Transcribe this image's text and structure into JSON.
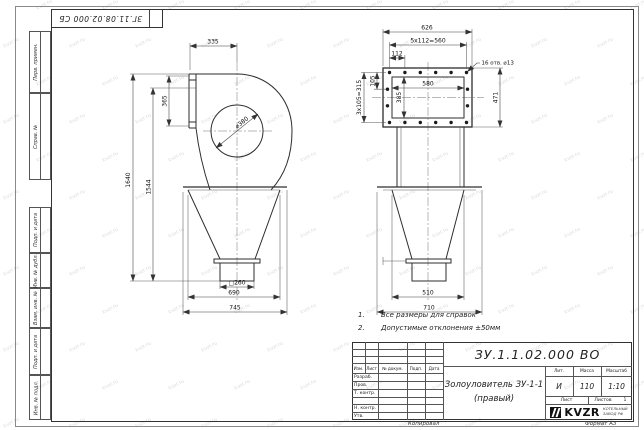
{
  "page": {
    "corner_stamp": "ЗГ.11.08.02.000 СБ",
    "copied_label": "Копировал",
    "format_label": "Формат А3",
    "watermark_text": "kvzr.ru"
  },
  "left_margin": {
    "labels": [
      "Перв. примен.",
      "Справ. №",
      "Подп. и дата",
      "Инв. № дубл.",
      "Взам. инв. №",
      "Подп. и дата",
      "Инв. № подл."
    ]
  },
  "notes": {
    "n1_num": "1.",
    "n1_text": "Все размеры для справок",
    "n2_num": "2.",
    "n2_text": "Допустимые отклонения ±50мм"
  },
  "title_block": {
    "doc_number": "ЗУ.1.1.02.000 ВО",
    "product_name_line1": "Золоуловитель ЗУ-1-1",
    "product_name_line2": "(правый)",
    "col_izm": "Изм.",
    "col_list": "Лист",
    "col_doc": "№ докум.",
    "col_sign": "Подп.",
    "col_date": "Дата",
    "row_developed": "Разраб.",
    "row_checked": "Пров.",
    "row_tcontrol": "Т. контр.",
    "row_ncontrol": "Н. контр.",
    "row_approved": "Утв.",
    "lit_label": "Лит.",
    "lit_value": "И",
    "mass_label": "Масса",
    "mass_value": "110",
    "scale_label": "Масштаб",
    "scale_value": "1:10",
    "sheet_label": "Лист",
    "sheets_label": "Листов",
    "sheets_value": "1",
    "logo_text": "KVZR",
    "org_line1": "КОТЕЛЬНЫЙ",
    "org_line2": "ЗАВОД РФ"
  },
  "views": {
    "left": {
      "dim_inlet_offset": "335",
      "dim_flange_height": "365",
      "dim_eye_diameter": "⌀380",
      "dim_total_height": "1640",
      "dim_body_height": "1544",
      "dim_outlet": "□260",
      "dim_hopper_width": "690",
      "dim_flange_width": "745"
    },
    "right": {
      "dim_flange_width": "626",
      "dim_holes_horizontal": "5х112=560",
      "dim_hole_step": "112",
      "dim_holes_note": "16 отв. ⌀13",
      "dim_hole_step_v": "105",
      "dim_holes_vertical": "3х105=315",
      "dim_opening_height": "385",
      "dim_opening_width": "580",
      "dim_flange_height": "471",
      "dim_hopper_width": "510",
      "dim_hopper_flange_width": "710"
    }
  }
}
